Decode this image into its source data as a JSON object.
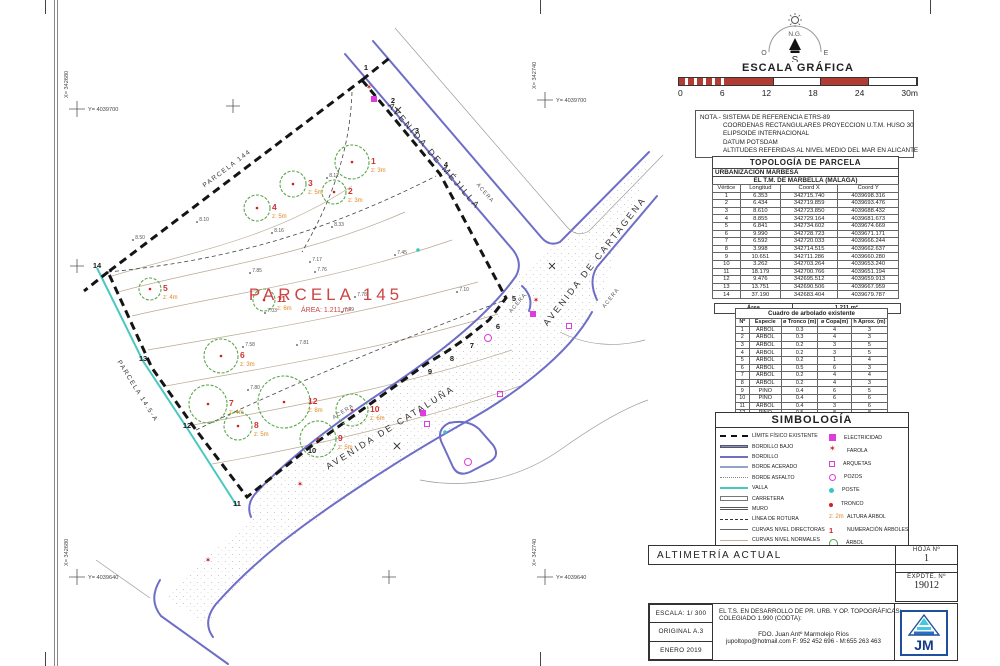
{
  "compass": {
    "north_label": "N.G.",
    "west": "O",
    "east": "E",
    "south": "S"
  },
  "scale_bar": {
    "title": "ESCALA GRÁFICA",
    "ticks": [
      "0",
      "6",
      "12",
      "18",
      "24",
      "30m"
    ]
  },
  "note": {
    "line1": "NOTA.- SISTEMA DE REFERENCIA ETRS-89",
    "line2": "COORDENAS RECTANGULARES PROYECCION U.T.M. HUSO 30",
    "line3": "ELIPSOIDE  INTERNACIONAL",
    "line4": "DATUM POTSDAM",
    "line5": "ALTITUDES REFERIDAS AL NIVEL MEDIO DEL MAR EN ALICANTE"
  },
  "topology": {
    "title": "TOPOLOGÍA DE PARCELA",
    "subtitle1": "URBANIZACIÓN MARBESA",
    "subtitle2": "EL T.M. DE MARBELLA (MÁLAGA)",
    "headers": [
      "Vértice",
      "Longitud",
      "Coord X",
      "Coord Y"
    ],
    "rows": [
      [
        "1",
        "6.353",
        "342715.740",
        "4039698.316"
      ],
      [
        "2",
        "6.434",
        "342719.859",
        "4039693.476"
      ],
      [
        "3",
        "8.610",
        "342723.850",
        "4039688.432"
      ],
      [
        "4",
        "8.855",
        "342729.164",
        "4039681.673"
      ],
      [
        "5",
        "6.841",
        "342734.602",
        "4039674.669"
      ],
      [
        "6",
        "9.990",
        "342728.723",
        "4039671.171"
      ],
      [
        "7",
        "6.592",
        "342720.033",
        "4039666.244"
      ],
      [
        "8",
        "3.998",
        "342714.515",
        "4039662.637"
      ],
      [
        "9",
        "10.651",
        "342711.286",
        "4039660.280"
      ],
      [
        "10",
        "3.262",
        "342703.264",
        "4039653.240"
      ],
      [
        "11",
        "18.179",
        "342700.766",
        "4039651.194"
      ],
      [
        "12",
        "9.476",
        "342695.512",
        "4039659.913"
      ],
      [
        "13",
        "13.751",
        "342690.506",
        "4039667.959"
      ],
      [
        "14",
        "37.190",
        "342683.404",
        "4039679.787"
      ]
    ],
    "area_label": "Área",
    "area_value": "1.211 m²"
  },
  "trees_table": {
    "title": "Cuadro de arbolado existente",
    "headers": [
      "Nº",
      "Especie",
      "ø Tronco (m)",
      "ø Copa(m)",
      "h Aprox. (m)"
    ],
    "rows": [
      [
        "1",
        "ÁRBOL",
        "0.3",
        "4",
        "3"
      ],
      [
        "2",
        "ÁRBOL",
        "0.3",
        "4",
        "3"
      ],
      [
        "3",
        "ÁRBOL",
        "0.2",
        "3",
        "5"
      ],
      [
        "4",
        "ÁRBOL",
        "0.2",
        "3",
        "5"
      ],
      [
        "5",
        "ÁRBOL",
        "0.2",
        "1",
        "4"
      ],
      [
        "6",
        "ÁRBOL",
        "0.5",
        "6",
        "3"
      ],
      [
        "7",
        "ÁRBOL",
        "0.2",
        "4",
        "4"
      ],
      [
        "8",
        "ÁRBOL",
        "0.2",
        "4",
        "3"
      ],
      [
        "9",
        "PINO",
        "0.4",
        "6",
        "5"
      ],
      [
        "10",
        "PINO",
        "0.4",
        "6",
        "6"
      ],
      [
        "11",
        "ÁRBOL",
        "0.4",
        "3",
        "6"
      ],
      [
        "12",
        "PINO",
        "0.5",
        "8",
        "8"
      ]
    ]
  },
  "legend": {
    "title": "SIMBOLOGÍA",
    "left": [
      {
        "cls": "sw-limite",
        "label": "LÍMITE FÍSICO EXISTENTE"
      },
      {
        "cls": "sw-bordillo-bajo",
        "label": "BORDILLO BAJO"
      },
      {
        "cls": "sw-bordillo",
        "label": "BORDILLO"
      },
      {
        "cls": "sw-borde-acerado",
        "label": "BORDE ACERADO"
      },
      {
        "cls": "sw-borde-asfalto",
        "label": "BORDE ASFALTO"
      },
      {
        "cls": "sw-valla",
        "label": "VALLA"
      },
      {
        "cls": "sw-carretera",
        "label": "CARRETERA"
      },
      {
        "cls": "sw-muro",
        "label": "MURO"
      },
      {
        "cls": "sw-rotura",
        "label": "LÍNEA DE ROTURA"
      },
      {
        "cls": "sw-directoras",
        "label": "CURVAS NIVEL DIRECTORAS"
      },
      {
        "cls": "sw-normales",
        "label": "CURVAS NIVEL NORMALES"
      },
      {
        "cls": "sw-punto-cota",
        "label": "PUNTO COTA",
        "sym": "8.88"
      }
    ],
    "right": [
      {
        "cls": "sw-elec",
        "label": "ELECTRICIDAD"
      },
      {
        "cls": "sw-farola",
        "label": "FAROLA"
      },
      {
        "cls": "sw-arqueta",
        "label": "ARQUETAS"
      },
      {
        "cls": "sw-pozo",
        "label": "POZOS"
      },
      {
        "cls": "sw-poste",
        "label": "POSTE"
      },
      {
        "cls": "sw-tronco",
        "label": "TRONCO"
      },
      {
        "cls": "sw-altura",
        "label": "ALTURA ÁRBOL",
        "sym": "z: 2m"
      },
      {
        "cls": "sw-numarb",
        "label": "NUMERACIÓN ÁRBOLES",
        "sym": "1"
      },
      {
        "cls": "sw-arbol",
        "label": "ÁRBOL"
      }
    ]
  },
  "titleblock": {
    "hoja_label": "HOJA Nº",
    "hoja_value": "1",
    "expdte_label": "EXPDTE.  Nº",
    "expdte_value": "19012",
    "title": "ALTIMETRÍA ACTUAL",
    "escala": "ESCALA: 1/ 300",
    "original": "ORIGINAL  A.3",
    "fecha": "ENERO 2019",
    "center_line1": "EL T.S. EN DESARROLLO DE PR. URB. Y OP. TOPOGRÁFICAS:",
    "center_line2": "COLEGIADO 1.990 (CODTA):",
    "fdo": "FDO. Juan Antº Marmolejo Ríos",
    "contact": "jupoltopo@hotmail.com      F: 952 452 696 - M:655 263 463",
    "logo_text": "JM"
  },
  "plan": {
    "parcel_title": "PARCELA 145",
    "parcel_area": "ÁREA: 1.211 m²",
    "street_labels": [
      {
        "text": "AVENIDA DE MÉJILLA",
        "x": 432,
        "y": 158,
        "r": 49.5,
        "cls": "lbl-street"
      },
      {
        "text": "AVENIDA DE CARTAGENA",
        "x": 597,
        "y": 263,
        "r": -52,
        "cls": "lbl-street"
      },
      {
        "text": "AVENIDA DE CATALUÑA",
        "x": 392,
        "y": 430,
        "r": -32,
        "cls": "lbl-street"
      },
      {
        "text": "ACERA",
        "x": 484,
        "y": 194,
        "r": 49.5,
        "cls": "lbl-acera"
      },
      {
        "text": "ACERA",
        "x": 612,
        "y": 299,
        "r": -52,
        "cls": "lbl-acera"
      },
      {
        "text": "ACERA",
        "x": 344,
        "y": 413,
        "r": -32,
        "cls": "lbl-acera"
      },
      {
        "text": "ACERA",
        "x": 519,
        "y": 304,
        "r": -50,
        "cls": "lbl-acera"
      },
      {
        "text": "PARCELA 144",
        "x": 228,
        "y": 170,
        "r": -37,
        "cls": "lbl-parcel"
      },
      {
        "text": "PARCELA 14.5-A",
        "x": 136,
        "y": 392,
        "r": 58,
        "cls": "lbl-parcel"
      }
    ],
    "grid_labels": [
      {
        "x": 77,
        "y": 109,
        "xl": "X= 342680",
        "yl": "Y= 4039700"
      },
      {
        "x": 545,
        "y": 100,
        "xl": "X= 342740",
        "yl": "Y= 4039700"
      },
      {
        "x": 77,
        "y": 577,
        "xl": "X= 342680",
        "yl": "Y= 4039640"
      },
      {
        "x": 545,
        "y": 577,
        "xl": "X= 342740",
        "yl": "Y= 4039640"
      }
    ],
    "grid_crosses": [
      {
        "x": 233,
        "y": 106
      },
      {
        "x": 77,
        "y": 266
      },
      {
        "x": 389,
        "y": 577
      }
    ],
    "vertices": [
      {
        "n": "1",
        "x": 366,
        "y": 70
      },
      {
        "n": "2",
        "x": 393,
        "y": 103
      },
      {
        "n": "3",
        "x": 417,
        "y": 133
      },
      {
        "n": "4",
        "x": 446,
        "y": 167
      },
      {
        "n": "5",
        "x": 514,
        "y": 301
      },
      {
        "n": "6",
        "x": 498,
        "y": 329
      },
      {
        "n": "7",
        "x": 472,
        "y": 348
      },
      {
        "n": "8",
        "x": 452,
        "y": 361
      },
      {
        "n": "9",
        "x": 430,
        "y": 374
      },
      {
        "n": "10",
        "x": 312,
        "y": 453
      },
      {
        "n": "11",
        "x": 237,
        "y": 506
      },
      {
        "n": "12",
        "x": 187,
        "y": 428
      },
      {
        "n": "13",
        "x": 143,
        "y": 361
      },
      {
        "n": "14",
        "x": 97,
        "y": 268
      }
    ],
    "trees": [
      {
        "n": "1",
        "z": "z: 3m",
        "x": 352,
        "y": 162,
        "r": 17,
        "lx": 19
      },
      {
        "n": "2",
        "z": "z: 3m",
        "x": 334,
        "y": 192,
        "r": 12,
        "lx": 14
      },
      {
        "n": "3",
        "z": "z: 5m",
        "x": 293,
        "y": 184,
        "r": 13,
        "lx": 15
      },
      {
        "n": "4",
        "z": "z: 5m",
        "x": 257,
        "y": 208,
        "r": 13,
        "lx": 15
      },
      {
        "n": "5",
        "z": "z: 4m",
        "x": 150,
        "y": 289,
        "r": 11,
        "lx": 13
      },
      {
        "n": "6",
        "z": "z: 3m",
        "x": 221,
        "y": 356,
        "r": 17,
        "lx": 19
      },
      {
        "n": "7",
        "z": "z: 4m",
        "x": 208,
        "y": 404,
        "r": 19,
        "lx": 21
      },
      {
        "n": "8",
        "z": "z: 5m",
        "x": 238,
        "y": 426,
        "r": 14,
        "lx": 16
      },
      {
        "n": "9",
        "z": "z: 5m",
        "x": 318,
        "y": 439,
        "r": 18,
        "lx": 20
      },
      {
        "n": "10",
        "z": "z: 6m",
        "x": 352,
        "y": 410,
        "r": 16,
        "lx": 18
      },
      {
        "n": "11",
        "z": "z: 6m",
        "x": 264,
        "y": 300,
        "r": 11,
        "lx": 13
      },
      {
        "n": "12",
        "z": "z: 8m",
        "x": 284,
        "y": 402,
        "r": 26,
        "lx": 24
      }
    ],
    "spot_elevations": [
      {
        "v": "7.85",
        "x": 250,
        "y": 273
      },
      {
        "v": "7.76",
        "x": 315,
        "y": 272
      },
      {
        "v": "7.03",
        "x": 265,
        "y": 313
      },
      {
        "v": "7.59",
        "x": 342,
        "y": 312
      },
      {
        "v": "7.78",
        "x": 355,
        "y": 297
      },
      {
        "v": "8.12",
        "x": 327,
        "y": 178
      },
      {
        "v": "8.33",
        "x": 332,
        "y": 227
      },
      {
        "v": "8.16",
        "x": 272,
        "y": 233
      },
      {
        "v": "7.58",
        "x": 243,
        "y": 347
      },
      {
        "v": "7.81",
        "x": 297,
        "y": 345
      },
      {
        "v": "7.80",
        "x": 248,
        "y": 390
      },
      {
        "v": "8.10",
        "x": 197,
        "y": 222
      },
      {
        "v": "8.50",
        "x": 133,
        "y": 240
      },
      {
        "v": "7.45",
        "x": 395,
        "y": 255
      },
      {
        "v": "7.17",
        "x": 310,
        "y": 262
      },
      {
        "v": "7.10",
        "x": 457,
        "y": 292
      }
    ],
    "symbols": {
      "electricidad": [
        {
          "x": 374,
          "y": 99
        },
        {
          "x": 533,
          "y": 314
        },
        {
          "x": 423,
          "y": 413
        }
      ],
      "arquetas": [
        {
          "x": 427,
          "y": 424
        },
        {
          "x": 569,
          "y": 326
        },
        {
          "x": 500,
          "y": 394
        }
      ],
      "pozos": [
        {
          "x": 468,
          "y": 462
        },
        {
          "x": 488,
          "y": 338
        }
      ],
      "farolas": [
        {
          "x": 369,
          "y": 87
        },
        {
          "x": 536,
          "y": 300
        },
        {
          "x": 300,
          "y": 484
        },
        {
          "x": 208,
          "y": 560
        }
      ],
      "postes": [
        {
          "x": 445,
          "y": 432
        },
        {
          "x": 418,
          "y": 250
        }
      ],
      "cross_marks": [
        {
          "x": 398,
          "y": 110
        },
        {
          "x": 552,
          "y": 266
        },
        {
          "x": 397,
          "y": 446
        }
      ]
    }
  }
}
